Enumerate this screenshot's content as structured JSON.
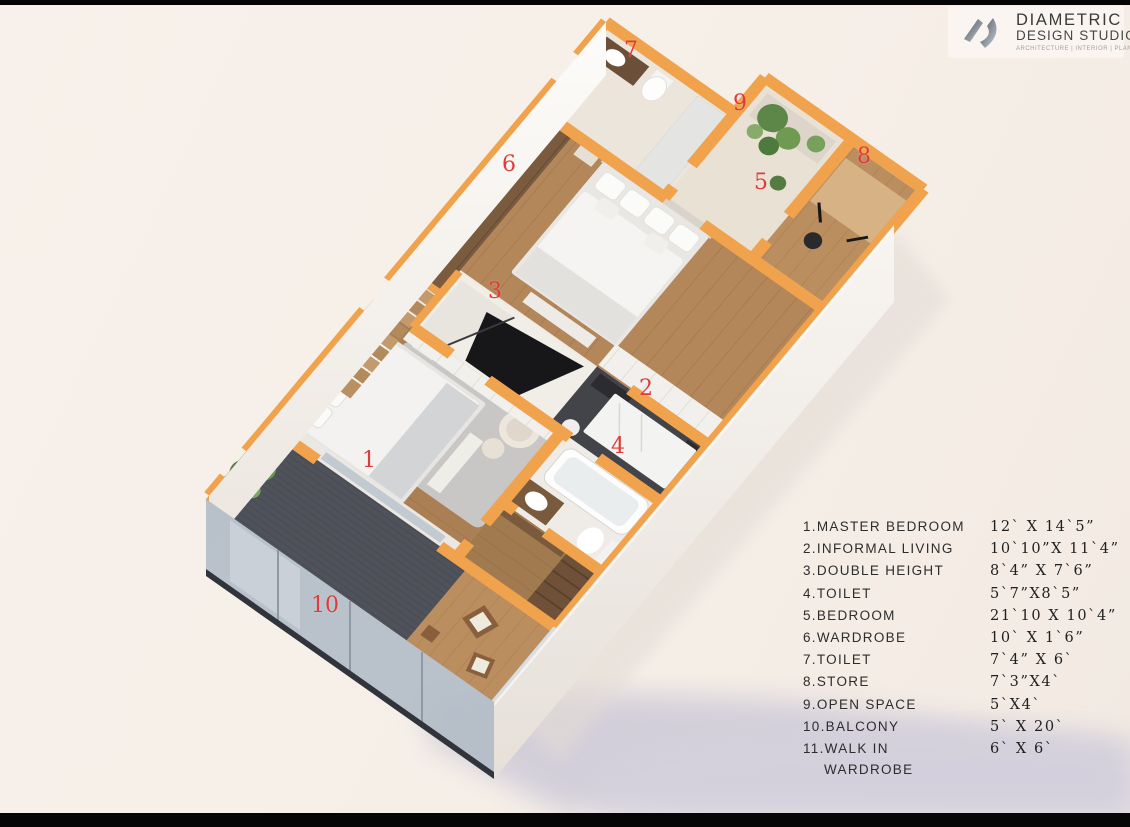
{
  "logo": {
    "mark": "ds-monogram-swoosh",
    "line1": "DIAMETRIC",
    "line2": "DESIGN STUDIO",
    "tagline": "ARCHITECTURE | INTERIOR | PLANNING"
  },
  "plan": {
    "labels": [
      {
        "n": "1",
        "x": 369,
        "y": 461
      },
      {
        "n": "2",
        "x": 646,
        "y": 389
      },
      {
        "n": "3",
        "x": 495,
        "y": 292
      },
      {
        "n": "4",
        "x": 618,
        "y": 447
      },
      {
        "n": "5",
        "x": 761,
        "y": 183
      },
      {
        "n": "6",
        "x": 509,
        "y": 165
      },
      {
        "n": "7",
        "x": 631,
        "y": 51
      },
      {
        "n": "8",
        "x": 864,
        "y": 157
      },
      {
        "n": "9",
        "x": 740,
        "y": 104
      },
      {
        "n": "10",
        "x": 325,
        "y": 606
      }
    ]
  },
  "legend": {
    "rows": [
      {
        "name": "1.MASTER BEDROOM",
        "size": "12` X 14`5”"
      },
      {
        "name": "2.INFORMAL LIVING",
        "size": "10`10”X 11`4”"
      },
      {
        "name": "3.DOUBLE HEIGHT",
        "size": "8`4” X 7`6”"
      },
      {
        "name": "4.TOILET",
        "size": "5`7”X8`5”"
      },
      {
        "name": "5.BEDROOM",
        "size": "21`10 X 10`4”"
      },
      {
        "name": "6.WARDROBE",
        "size": "10` X 1`6”"
      },
      {
        "name": "7.TOILET",
        "size": "7`4” X 6`"
      },
      {
        "name": "8.STORE",
        "size": "7`3”X4`"
      },
      {
        "name": "9.OPEN SPACE",
        "size": "5`X4`"
      },
      {
        "name": "10.BALCONY",
        "size": "5` X 20`"
      },
      {
        "name": "11.WALK IN",
        "name2": "WARDROBE",
        "size": "6` X 6`"
      }
    ]
  },
  "colors": {
    "label_red": "#e03b3b",
    "accent_orange": "#f0a24c",
    "background": "#f6efe8",
    "deck_gray": "#53555e",
    "wood_brown": "#b3875a",
    "shadow_blue": "#c8c5d6"
  }
}
